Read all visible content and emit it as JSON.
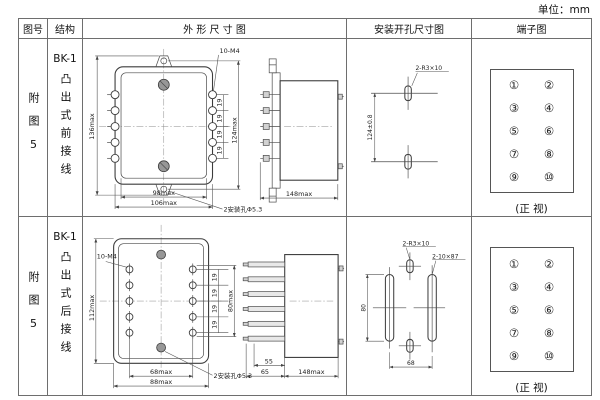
{
  "page": {
    "unit_label": "单位：mm"
  },
  "table": {
    "headers": {
      "fig_no": "图号",
      "structure": "结构",
      "outline": "外 形 尺 寸 图",
      "install": "安装开孔尺寸图",
      "terminal": "端子图"
    }
  },
  "rows": [
    {
      "fig_no": "附图5",
      "model": "BK-1",
      "structure_desc": "凸出式前接线",
      "outline": {
        "thread_label": "10-M4",
        "height_label": "136max",
        "pitch_label": "19",
        "span_label": "124max",
        "width_inner_label": "98max",
        "width_outer_label": "106max",
        "mount_hole_label": "2安装孔Φ5.3",
        "depth_label": "148max"
      },
      "install": {
        "span_label": "124±0.8",
        "slot_label": "2-R3×10"
      },
      "terminal": {
        "numbers": [
          "①",
          "②",
          "③",
          "④",
          "⑤",
          "⑥",
          "⑦",
          "⑧",
          "⑨",
          "⑩"
        ],
        "caption": "(正 视)"
      }
    },
    {
      "fig_no": "附图5",
      "model": "BK-1",
      "structure_desc": "凸出式后接线",
      "outline": {
        "thread_label": "10-M4",
        "height_label": "112max",
        "pitch_label": "19",
        "span_label": "80max",
        "width_inner_label": "68max",
        "width_outer_label": "88max",
        "mount_hole_label": "2安装孔Φ5.3",
        "stud_inner_label": "55",
        "stud_outer_label": "65",
        "depth_label": "148max"
      },
      "install": {
        "height_label": "80",
        "width_label": "68",
        "slot_label": "2-R3×10",
        "cutout_label": "2-10×87"
      },
      "terminal": {
        "numbers": [
          "①",
          "②",
          "③",
          "④",
          "⑤",
          "⑥",
          "⑦",
          "⑧",
          "⑨",
          "⑩"
        ],
        "caption": "(正 视)"
      }
    }
  ]
}
